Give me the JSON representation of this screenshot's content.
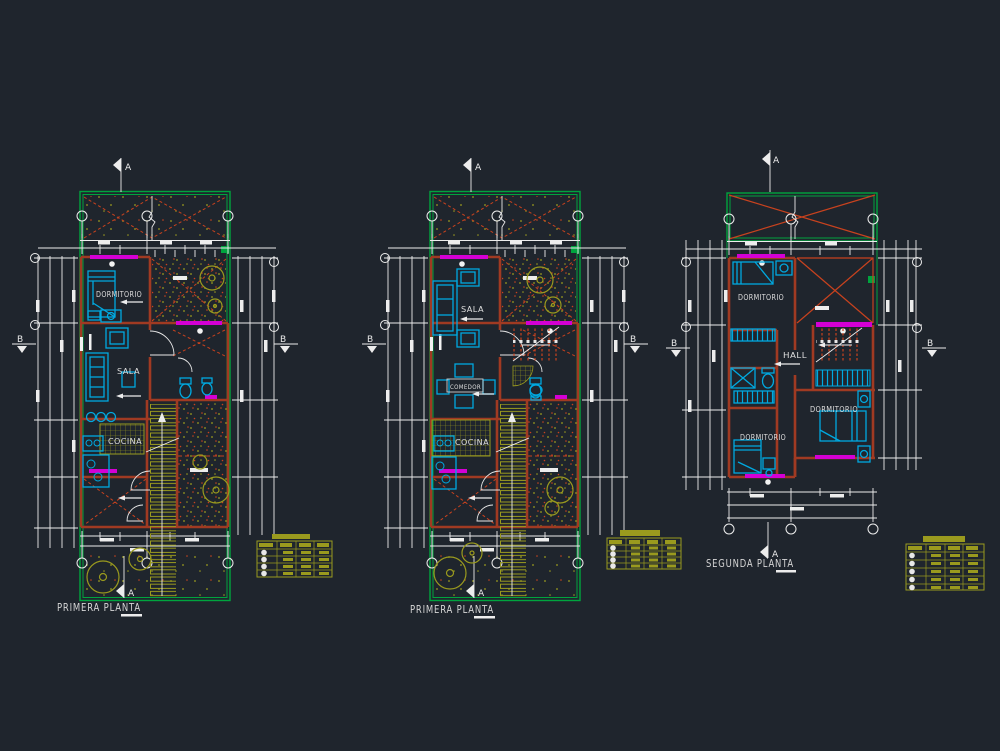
{
  "drawing": {
    "background": "#1f252d",
    "palette": {
      "lot_green": "#00a43e",
      "wall_red": "#a03a22",
      "accent_red": "#c8421e",
      "window_magenta": "#d400d4",
      "furniture_cyan": "#00a9e0",
      "hatch_yellow": "#9a9a1e",
      "dimension_white": "#ededed"
    },
    "section_markers": {
      "a": "A",
      "b": "B"
    },
    "plans": [
      {
        "title": "PRIMERA PLANTA",
        "rooms": {
          "bedroom": "DORMITORIO",
          "living": "SALA",
          "kitchen": "COCINA"
        }
      },
      {
        "title": "PRIMERA PLANTA",
        "rooms": {
          "living": "SALA",
          "dining": "COMEDOR",
          "kitchen": "COCINA"
        }
      },
      {
        "title": "SEGUNDA PLANTA",
        "rooms": {
          "bedroom_1": "DORMITORIO",
          "bedroom_2": "DORMITORIO",
          "bedroom_3": "DORMITORIO",
          "hall": "HALL"
        }
      }
    ],
    "schedule_tables": [
      {
        "position": "left",
        "columns": 4,
        "rows": 4
      },
      {
        "position": "middle",
        "columns": 4,
        "rows": 4
      },
      {
        "position": "right",
        "columns": 4,
        "rows": 5
      }
    ]
  }
}
